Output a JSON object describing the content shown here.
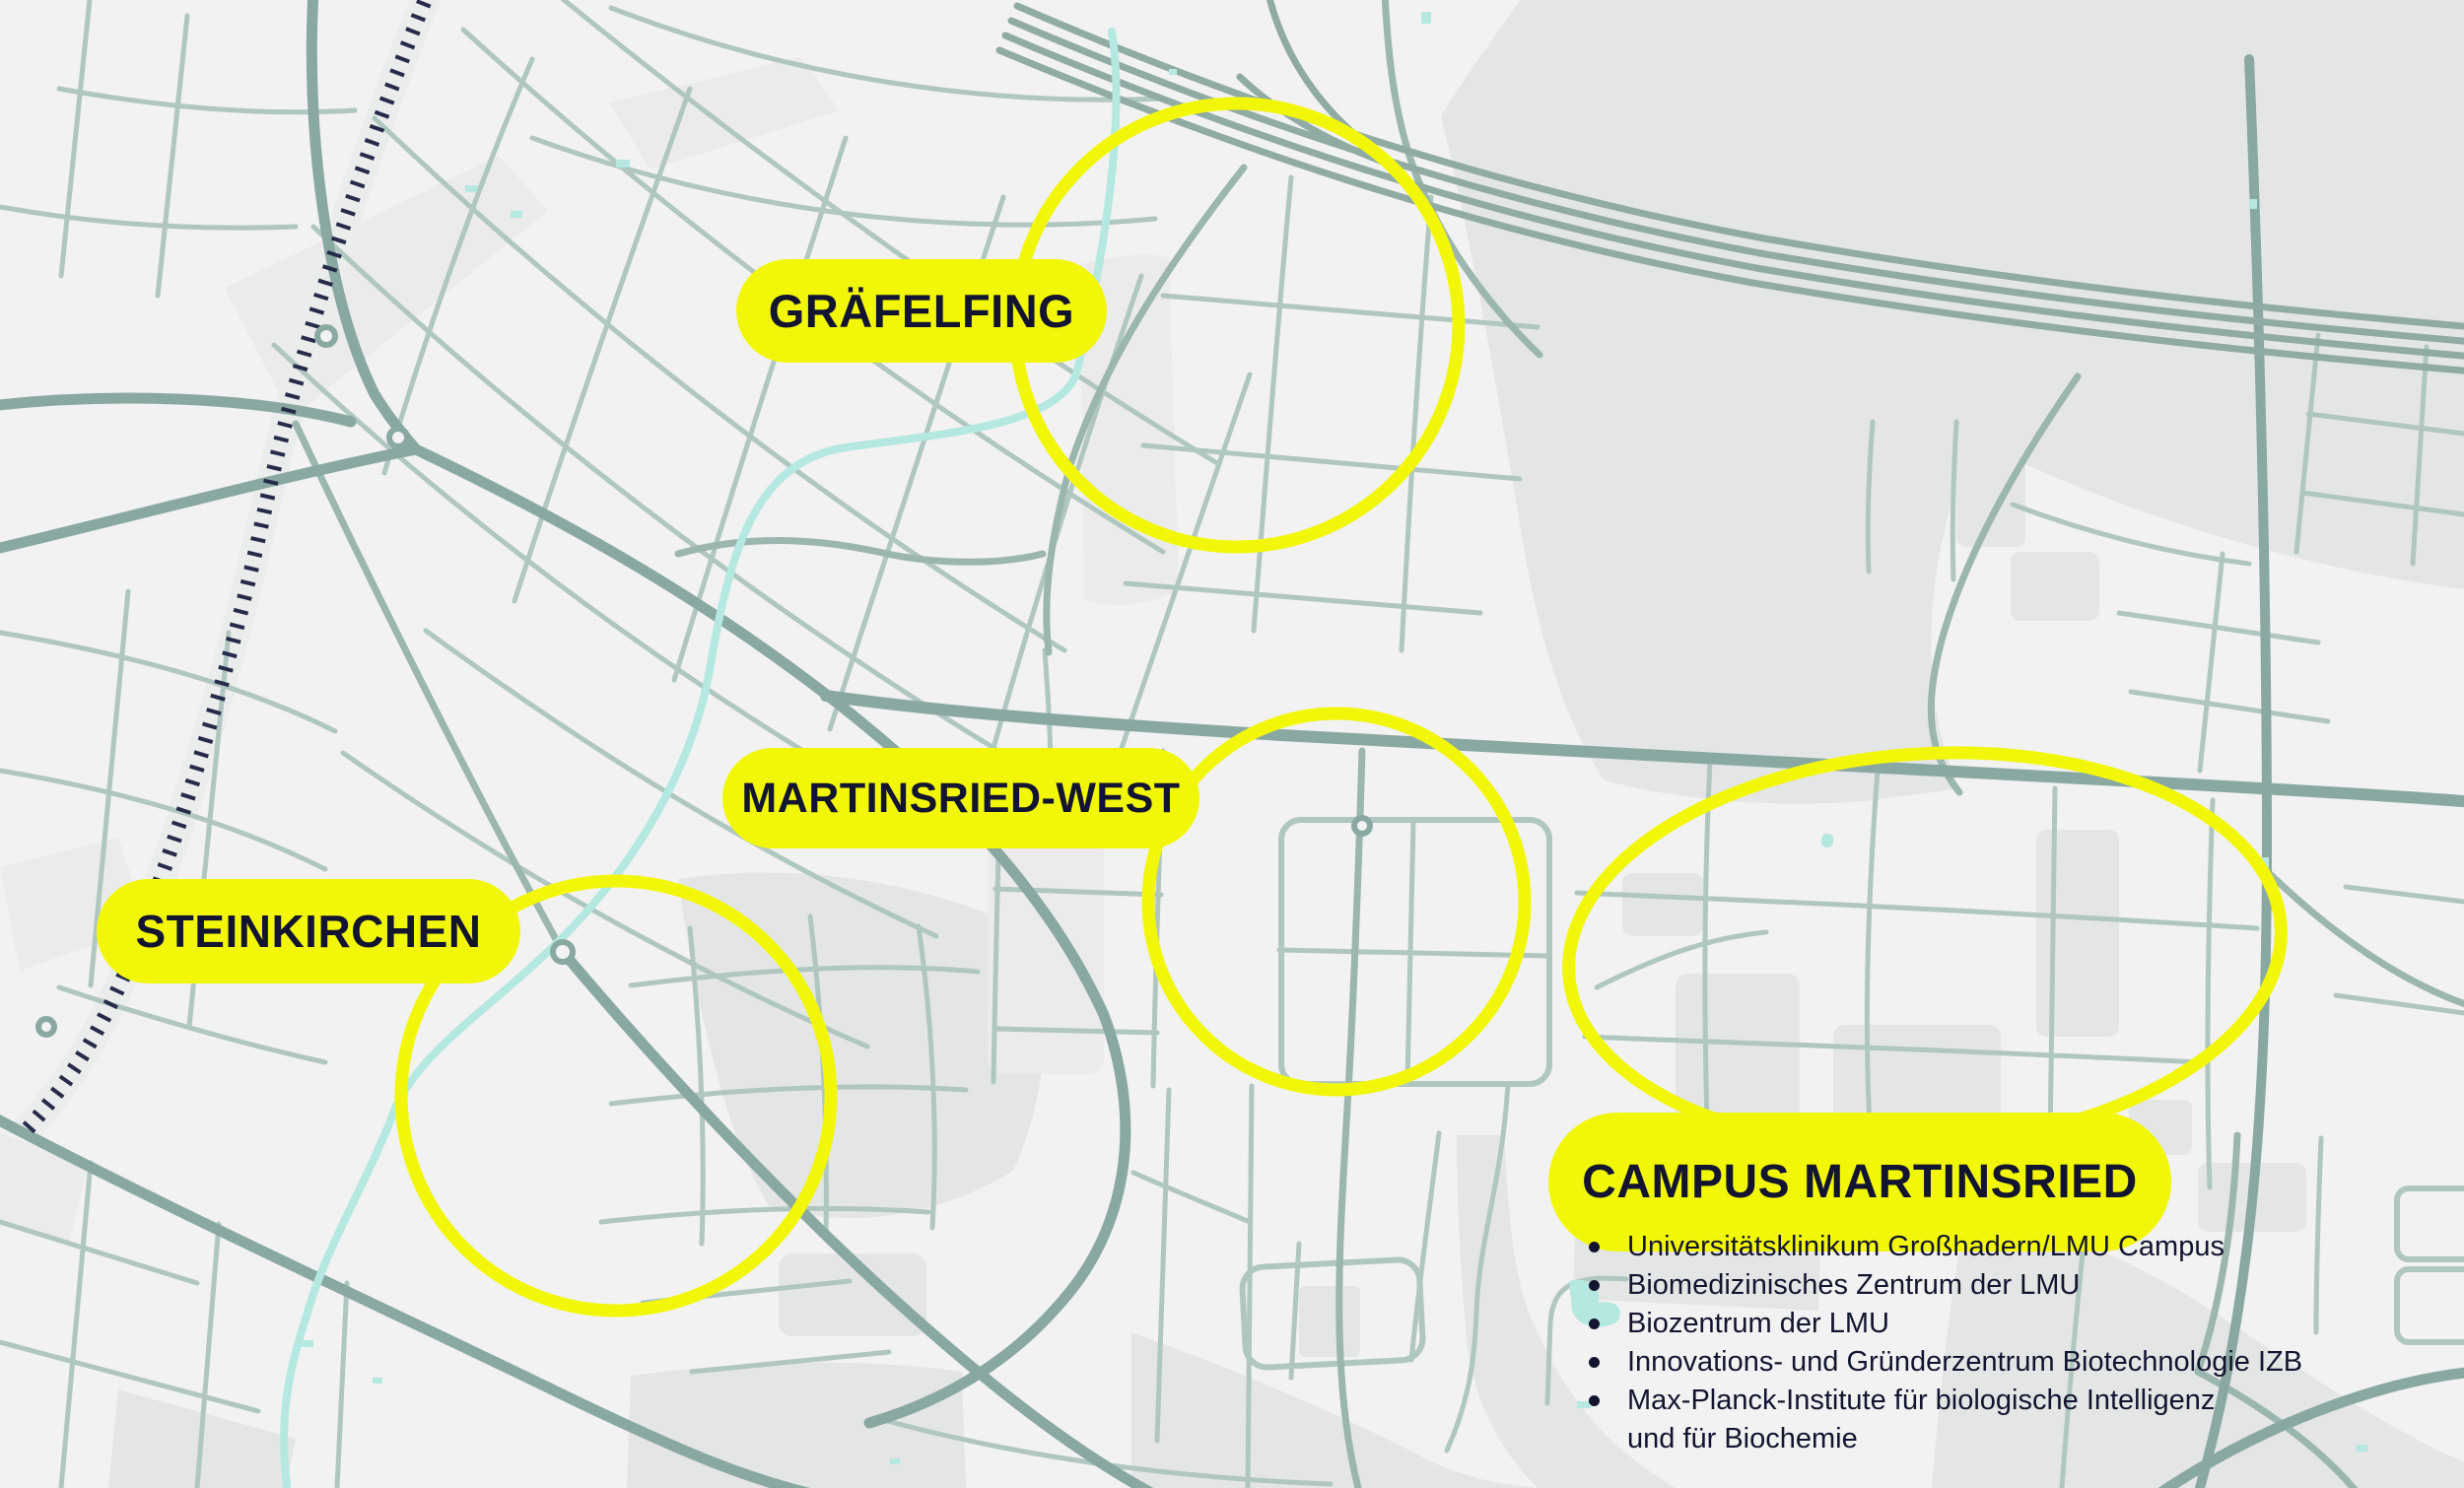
{
  "map": {
    "colors": {
      "background": "#f1f2f1",
      "area": "#e4e6e5",
      "area_light": "#eaebea",
      "road_light": "#b0c6c0",
      "road_med": "#9bb5af",
      "road_dark": "#8aa8a2",
      "motorway": "#90aaa4",
      "railway": "#252b49",
      "railway_band": "#ebedec",
      "water": "#b4e8e1",
      "highlight_yellow": "#f2f70a",
      "label_ink": "#13142f"
    },
    "labels": [
      {
        "id": "graefelfing",
        "text": "GRÄFELFING"
      },
      {
        "id": "martinsried-west",
        "text": "MARTINSRIED-WEST"
      },
      {
        "id": "steinkirchen",
        "text": "STEINKIRCHEN"
      },
      {
        "id": "campus-martinsried",
        "text": "CAMPUS MARTINSRIED"
      }
    ],
    "campus_list": [
      "Universitätsklinikum Großhadern/LMU Campus",
      "Biomedizinisches Zentrum der LMU",
      "Biozentrum der LMU",
      "Innovations- und Gründerzentrum Biotechnologie IZB",
      "Max-Planck-Institute für biologische Intelligenz\nund für Biochemie"
    ]
  }
}
